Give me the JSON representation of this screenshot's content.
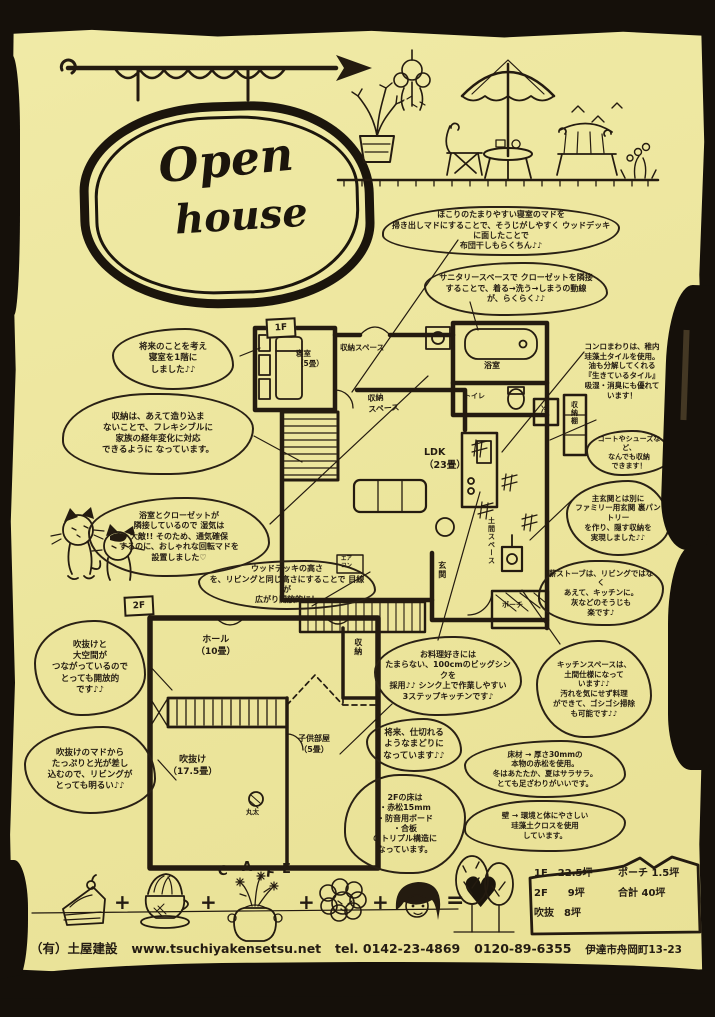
{
  "colors": {
    "paper": "#EFE9A2",
    "ink": "#211A10",
    "border": "#15100A"
  },
  "sign": {
    "line1": "Open",
    "line2": "house"
  },
  "bubbles": [
    "ほこりのたまりやすい寝室のマドを\n掃き出しマドにすることで、そうじがしやすく ウッドデッキに面したことで\n布団干しもらくちん♪♪",
    "サニタリースペースで クローゼットを隣接\nすることで、着る→洗う→しまうの動線\nが、らくらく♪♪",
    "将来のことを考え\n寝室を1階に\nしました♪♪",
    "収納は、あえて造り込ま\nないことで、フレキシブルに\n家族の経年変化に対応\nできるように なっています。",
    "浴室とクローゼットが\n隣接しているので 湿気は\n大敵!! そのため、通気確保\nするのに、おしゃれな回転マドを\n設置しました♡",
    "ウッドデッキの高さ\nを、リビングと同じ高さにすることで 目線が\n広がり開放的に！",
    "コンロまわりは、稚内\n珪藻土タイルを使用。\n油も分解してくれる\n『生きているタイル』\n吸湿・消臭にも優れて\nいます！",
    "コートやシューズなど、\nなんでも収納\nできます！",
    "主玄関とは別に\nファミリー用玄関 裏パントリー\nを作り、隠す収納を\n実現しました♪♪",
    "薪ストーブは、リビングではなく\nあえて、キッチンに。\n灰などのそうじも\n楽です♪",
    "お料理好きには\nたまらない、100cmのビッグシンクを\n採用♪♪ シンク上で作業しやすい\n3ステップキッチンです♪",
    "将来、仕切れる\nようなまどりに\nなっています♪♪",
    "2Fの床は\n・赤松15mm\n・防音用ボード\n・合板\nのトリプル構造に\nなっています。",
    "キッチンスペースは、\n土間仕様になって\nいます♪♪\n汚れを気にせず料理\nができて、ゴシゴシ掃除\nも可能です♪♪",
    "床材 → 厚さ30mmの\n本物の赤松を使用。\n冬はあたたか、夏はサラサラ。\nとても足ざわりがいいです。",
    "壁 → 環境と体にやさしい\n珪藻土クロスを使用\nしています。",
    "吹抜けと\n大空間が\nつながっているので\nとっても開放的\nです♪♪",
    "吹抜けのマドから\nたっぷりと光が差し\n込むので、リビングが\nとっても明るい♪♪"
  ],
  "plan1f": {
    "sign": "1F",
    "bedroom": "寝室\n（5畳）",
    "storage_top": "収納スペース",
    "storage_mid": "収納\nスペース",
    "ldk": "LDK\n（23畳）",
    "bath": "浴室",
    "toilet": "トイレ",
    "fridge": "冷",
    "shelf": "収納棚",
    "doma": "土間スペース",
    "entrance": "玄関",
    "porch": "ポーチ",
    "aircon": "エア\nコン"
  },
  "plan2f": {
    "sign": "2F",
    "hall": "ホール\n（10畳）",
    "storage": "収納",
    "kids": "子供部屋\n（5畳）",
    "void": "吹抜け\n（17.5畳）",
    "log": "丸太"
  },
  "cafe": {
    "letters": [
      "C",
      "A",
      "F",
      "E"
    ],
    "plus": "+",
    "equals": "=",
    "heart": "♥"
  },
  "area_table": {
    "r1c1": "1F　22.5坪",
    "r1c2": "ポーチ 1.5坪",
    "r2c1": "2F　　9坪",
    "r2c2": "合計 40坪",
    "r3c1": "吹抜　8坪"
  },
  "footer": {
    "company": "（有）土屋建設",
    "url": "www.tsuchiyakensetsu.net",
    "tel": "tel. 0142-23-4869",
    "freecall": "0120-89-6355",
    "address": "伊達市舟岡町13-23"
  }
}
